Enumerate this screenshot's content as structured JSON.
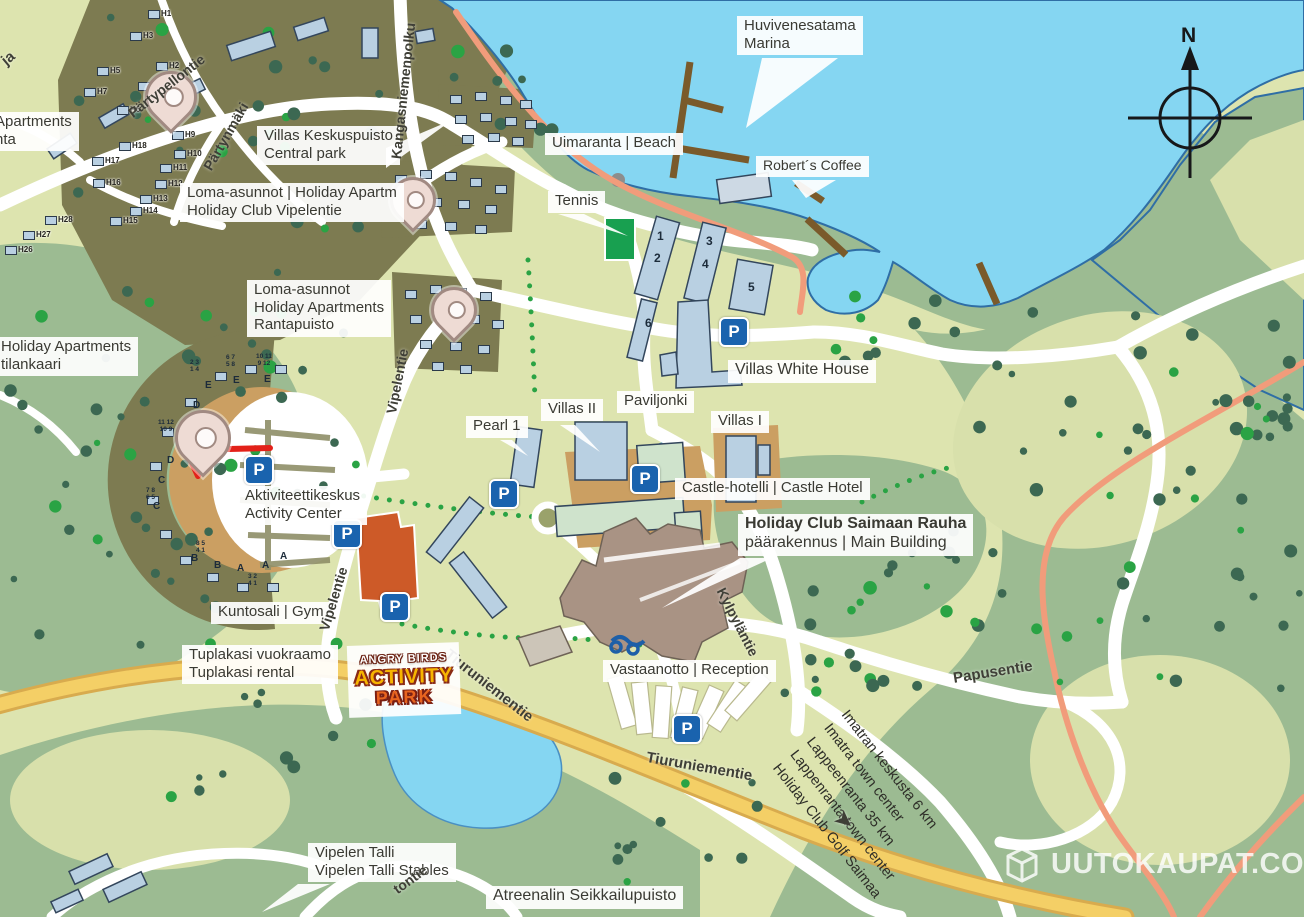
{
  "colors": {
    "water": "#85d6f2",
    "shore": "#2f6ea5",
    "land": "#dde4af",
    "sage": "#9cbb92",
    "sage_light": "#d8e0ab",
    "olive": "#7d7b51",
    "tan": "#cb9f62",
    "road_yellow": "#f4cf66",
    "road_yellow_edge": "#d8ab4e",
    "trail": "#f19c7b",
    "tree_dark": "#3c6852",
    "tree_bright": "#2aa344",
    "building": "#b9d0e2",
    "building_edge": "#33465c",
    "building_green": "#cfe3cc",
    "building_brown": "#a99384",
    "building_orange": "#cd5a28",
    "parking": "#1a63ae",
    "pin_fill": "#eedbd4",
    "pin_edge": "#a18a82",
    "red": "#e32119",
    "text": "#3a3a33",
    "pier": "#7a5a2b",
    "tennis": "#18a050"
  },
  "compass": {
    "label": "N"
  },
  "watermark": {
    "text": "UUTOKAUPAT.COM"
  },
  "angry_birds": {
    "line1": "ANGRY BIRDS",
    "line2": "ACTIVITY",
    "line3": "PARK"
  },
  "labels": [
    {
      "id": "huvivenesatama-marina",
      "x": 737,
      "y": 16,
      "box": true,
      "lines": [
        "Huvivenesatama",
        "Marina"
      ]
    },
    {
      "id": "uimaranta-beach",
      "x": 545,
      "y": 133,
      "box": true,
      "lines": [
        "Uimaranta | Beach"
      ]
    },
    {
      "id": "roberts-coffee",
      "x": 756,
      "y": 156,
      "box": true,
      "size": 14,
      "lines": [
        "Robert´s Coffee"
      ]
    },
    {
      "id": "tennis",
      "x": 548,
      "y": 191,
      "box": true,
      "lines": [
        "Tennis"
      ]
    },
    {
      "id": "villas-keskuspuisto",
      "x": 257,
      "y": 126,
      "box": true,
      "lines": [
        "Villas Keskuspuisto",
        "Central park"
      ]
    },
    {
      "id": "holiday-club-vipelentie",
      "x": 180,
      "y": 183,
      "box": true,
      "lines": [
        "Loma-asunnot  | Holiday Apartm",
        "Holiday Club Vipelentie"
      ]
    },
    {
      "id": "rantapuisto",
      "x": 247,
      "y": 280,
      "box": true,
      "lines": [
        "Loma-asunnot",
        "Holiday Apartments",
        "Rantapuisto"
      ]
    },
    {
      "id": "holiday-apartments-tilankaari",
      "x": -6,
      "y": 337,
      "box": true,
      "lines": [
        "Holiday Apartments",
        "tilankaari"
      ]
    },
    {
      "id": "apartments-edge",
      "x": -12,
      "y": 112,
      "box": true,
      "lines": [
        "Apartments",
        "nta"
      ]
    },
    {
      "id": "villas-white-house",
      "x": 728,
      "y": 360,
      "box": true,
      "size": 16,
      "lines": [
        "Villas White House"
      ]
    },
    {
      "id": "pearl-1",
      "x": 466,
      "y": 416,
      "box": true,
      "lines": [
        "Pearl 1"
      ]
    },
    {
      "id": "villas-ii",
      "x": 541,
      "y": 399,
      "box": true,
      "lines": [
        "Villas II"
      ]
    },
    {
      "id": "paviljonki",
      "x": 617,
      "y": 391,
      "box": true,
      "lines": [
        "Paviljonki"
      ]
    },
    {
      "id": "villas-i",
      "x": 711,
      "y": 411,
      "box": true,
      "lines": [
        "Villas I"
      ]
    },
    {
      "id": "castle-hotel",
      "x": 675,
      "y": 478,
      "box": true,
      "lines": [
        "Castle-hotelli  | Castle Hotel"
      ]
    },
    {
      "id": "main-building",
      "x": 738,
      "y": 514,
      "box": true,
      "size": 16,
      "bold": [
        0
      ],
      "lines": [
        "Holiday Club Saimaan Rauha",
        "päärakennus | Main Building"
      ]
    },
    {
      "id": "aktiviteettikeskus",
      "x": 238,
      "y": 486,
      "box": true,
      "lines": [
        "Aktiviteettikeskus",
        "Activity Center"
      ]
    },
    {
      "id": "kuntosali-gym",
      "x": 211,
      "y": 602,
      "box": true,
      "lines": [
        "Kuntosali | Gym"
      ]
    },
    {
      "id": "tuplakasi",
      "x": 182,
      "y": 645,
      "box": true,
      "lines": [
        "Tuplakasi vuokraamo",
        "Tuplakasi rental"
      ]
    },
    {
      "id": "vastaanotto-reception",
      "x": 603,
      "y": 660,
      "box": true,
      "lines": [
        "Vastaanotto | Reception"
      ]
    },
    {
      "id": "vipelen-talli",
      "x": 308,
      "y": 843,
      "box": true,
      "lines": [
        "Vipelen Talli",
        "Vipelen Talli Stables"
      ]
    },
    {
      "id": "atreenalin",
      "x": 486,
      "y": 886,
      "box": true,
      "size": 16,
      "lines": [
        "Atreenalin Seikkailupuisto"
      ]
    },
    {
      "id": "road-partypellontie",
      "x": 125,
      "y": 108,
      "rot": -38,
      "cls": "road",
      "size": 14,
      "lines": [
        "Pärtypellontie"
      ]
    },
    {
      "id": "road-partynmaki",
      "x": 200,
      "y": 165,
      "rot": -60,
      "cls": "road",
      "size": 14,
      "lines": [
        "Pärtynmäki"
      ]
    },
    {
      "id": "road-kangasniemenpolku",
      "x": 388,
      "y": 158,
      "rot": -84,
      "cls": "road",
      "size": 14,
      "lines": [
        "Kangasniemenpolku"
      ]
    },
    {
      "id": "road-vipelentie-n",
      "x": 383,
      "y": 412,
      "rot": -79,
      "cls": "road",
      "size": 14,
      "lines": [
        "Vipelentie"
      ]
    },
    {
      "id": "road-vipelentie-s",
      "x": 316,
      "y": 628,
      "rot": -73,
      "cls": "road",
      "size": 14,
      "lines": [
        "Vipelentie"
      ]
    },
    {
      "id": "road-kylpylantie",
      "x": 728,
      "y": 585,
      "rot": 63,
      "cls": "road",
      "size": 14,
      "lines": [
        "Kylpyläntie"
      ]
    },
    {
      "id": "road-tiuruniementie-1",
      "x": 452,
      "y": 646,
      "rot": 38,
      "cls": "road",
      "size": 15,
      "lines": [
        "Tiuruniementie"
      ]
    },
    {
      "id": "road-tiuruniementie-2",
      "x": 648,
      "y": 749,
      "rot": 10,
      "cls": "road",
      "size": 15,
      "lines": [
        "Tiuruniementie"
      ]
    },
    {
      "id": "road-papusentie",
      "x": 952,
      "y": 670,
      "rot": -9,
      "cls": "road",
      "size": 15,
      "lines": [
        "Papusentie"
      ]
    },
    {
      "id": "road-tontie-fragment",
      "x": 390,
      "y": 884,
      "rot": -36,
      "cls": "road",
      "size": 14,
      "lines": [
        "tontie"
      ]
    },
    {
      "id": "road-ja-fragment",
      "x": -2,
      "y": 56,
      "rot": -40,
      "cls": "road",
      "size": 15,
      "lines": [
        "ja"
      ]
    },
    {
      "id": "destinations",
      "x": 852,
      "y": 706,
      "rot": 52,
      "cls": "dest",
      "size": 14.5,
      "lines": [
        "Imatran keskusta 6 km",
        "Imatra town center",
        "Lappeenranta 35 km",
        "Lappenranta town center",
        "Holiday Club Golf Saimaa"
      ]
    },
    {
      "id": "golf-arrow",
      "x": 845,
      "y": 806,
      "rot": 40,
      "cls": "road",
      "size": 21,
      "lines": [
        "➤"
      ]
    }
  ],
  "parkings": {
    "symbol": "P",
    "positions": [
      [
        732,
        330
      ],
      [
        643,
        477
      ],
      [
        502,
        492
      ],
      [
        257,
        468
      ],
      [
        345,
        532
      ],
      [
        393,
        605
      ],
      [
        685,
        727
      ]
    ]
  },
  "pins": [
    {
      "x": 168,
      "y": 130,
      "s": 46
    },
    {
      "x": 410,
      "y": 228,
      "s": 40
    },
    {
      "x": 451,
      "y": 338,
      "s": 40
    },
    {
      "x": 200,
      "y": 474,
      "s": 50
    }
  ],
  "houses": [
    [
      148,
      10,
      "H1"
    ],
    [
      156,
      62,
      "H2"
    ],
    [
      130,
      32,
      "H3"
    ],
    [
      138,
      82,
      "H4"
    ],
    [
      97,
      67,
      "H5"
    ],
    [
      117,
      106,
      "H6"
    ],
    [
      84,
      88,
      "H7"
    ],
    [
      172,
      131,
      "H9"
    ],
    [
      174,
      150,
      "H10"
    ],
    [
      160,
      164,
      "H11"
    ],
    [
      155,
      180,
      "H12"
    ],
    [
      140,
      195,
      "H13"
    ],
    [
      130,
      207,
      "H14"
    ],
    [
      110,
      217,
      "H15"
    ],
    [
      93,
      179,
      "H16"
    ],
    [
      92,
      157,
      "H17"
    ],
    [
      119,
      142,
      "H18"
    ],
    [
      5,
      246,
      "H26"
    ],
    [
      23,
      231,
      "H27"
    ],
    [
      45,
      216,
      "H28"
    ],
    [
      450,
      95,
      ""
    ],
    [
      475,
      92,
      ""
    ],
    [
      500,
      96,
      ""
    ],
    [
      520,
      100,
      ""
    ],
    [
      455,
      115,
      ""
    ],
    [
      480,
      113,
      ""
    ],
    [
      505,
      117,
      ""
    ],
    [
      525,
      120,
      ""
    ],
    [
      462,
      135,
      ""
    ],
    [
      488,
      133,
      ""
    ],
    [
      512,
      137,
      ""
    ],
    [
      395,
      175,
      ""
    ],
    [
      420,
      170,
      ""
    ],
    [
      445,
      172,
      ""
    ],
    [
      470,
      178,
      ""
    ],
    [
      495,
      185,
      ""
    ],
    [
      400,
      200,
      ""
    ],
    [
      430,
      198,
      ""
    ],
    [
      458,
      200,
      ""
    ],
    [
      485,
      205,
      ""
    ],
    [
      415,
      220,
      ""
    ],
    [
      445,
      222,
      ""
    ],
    [
      475,
      225,
      ""
    ],
    [
      405,
      290,
      ""
    ],
    [
      430,
      285,
      ""
    ],
    [
      455,
      288,
      ""
    ],
    [
      480,
      292,
      ""
    ],
    [
      410,
      315,
      ""
    ],
    [
      440,
      312,
      ""
    ],
    [
      468,
      315,
      ""
    ],
    [
      492,
      320,
      ""
    ],
    [
      420,
      340,
      ""
    ],
    [
      450,
      342,
      ""
    ],
    [
      478,
      345,
      ""
    ],
    [
      432,
      362,
      ""
    ],
    [
      460,
      365,
      ""
    ],
    [
      215,
      372,
      ""
    ],
    [
      245,
      365,
      ""
    ],
    [
      275,
      365,
      ""
    ],
    [
      185,
      398,
      ""
    ],
    [
      162,
      428,
      ""
    ],
    [
      150,
      462,
      ""
    ],
    [
      147,
      496,
      ""
    ],
    [
      160,
      530,
      ""
    ],
    [
      180,
      556,
      ""
    ],
    [
      207,
      573,
      ""
    ],
    [
      237,
      583,
      ""
    ],
    [
      267,
      583,
      ""
    ]
  ],
  "marks": [
    {
      "x": 205,
      "y": 381,
      "t": "E",
      "s": 10
    },
    {
      "x": 233,
      "y": 376,
      "t": "E",
      "s": 10
    },
    {
      "x": 264,
      "y": 375,
      "t": "E",
      "s": 10
    },
    {
      "x": 193,
      "y": 401,
      "t": "D",
      "s": 10
    },
    {
      "x": 167,
      "y": 456,
      "t": "D",
      "s": 10
    },
    {
      "x": 158,
      "y": 476,
      "t": "C",
      "s": 10
    },
    {
      "x": 153,
      "y": 502,
      "t": "C",
      "s": 10
    },
    {
      "x": 191,
      "y": 554,
      "t": "B",
      "s": 10
    },
    {
      "x": 214,
      "y": 561,
      "t": "B",
      "s": 10
    },
    {
      "x": 237,
      "y": 564,
      "t": "A",
      "s": 10
    },
    {
      "x": 262,
      "y": 561,
      "t": "A",
      "s": 10
    },
    {
      "x": 280,
      "y": 552,
      "t": "A",
      "s": 10
    },
    {
      "x": 190,
      "y": 360,
      "t": "2 3\n1 4",
      "s": 6.5
    },
    {
      "x": 226,
      "y": 355,
      "t": "6 7\n5 8",
      "s": 6.5
    },
    {
      "x": 256,
      "y": 354,
      "t": "10 11\n9 12",
      "s": 6.5
    },
    {
      "x": 158,
      "y": 420,
      "t": "11 12\n10 9",
      "s": 6.5
    },
    {
      "x": 146,
      "y": 488,
      "t": "7 8\n6 5",
      "s": 6.5
    },
    {
      "x": 196,
      "y": 541,
      "t": "8 5\n4 1",
      "s": 6.5
    },
    {
      "x": 248,
      "y": 574,
      "t": "3 2\n4 1",
      "s": 6.5
    },
    {
      "x": 657,
      "y": 230,
      "t": "1",
      "s": 12
    },
    {
      "x": 654,
      "y": 252,
      "t": "2",
      "s": 12
    },
    {
      "x": 706,
      "y": 235,
      "t": "3",
      "s": 12
    },
    {
      "x": 702,
      "y": 258,
      "t": "4",
      "s": 12
    },
    {
      "x": 748,
      "y": 281,
      "t": "5",
      "s": 12
    },
    {
      "x": 645,
      "y": 317,
      "t": "6",
      "s": 12
    }
  ]
}
